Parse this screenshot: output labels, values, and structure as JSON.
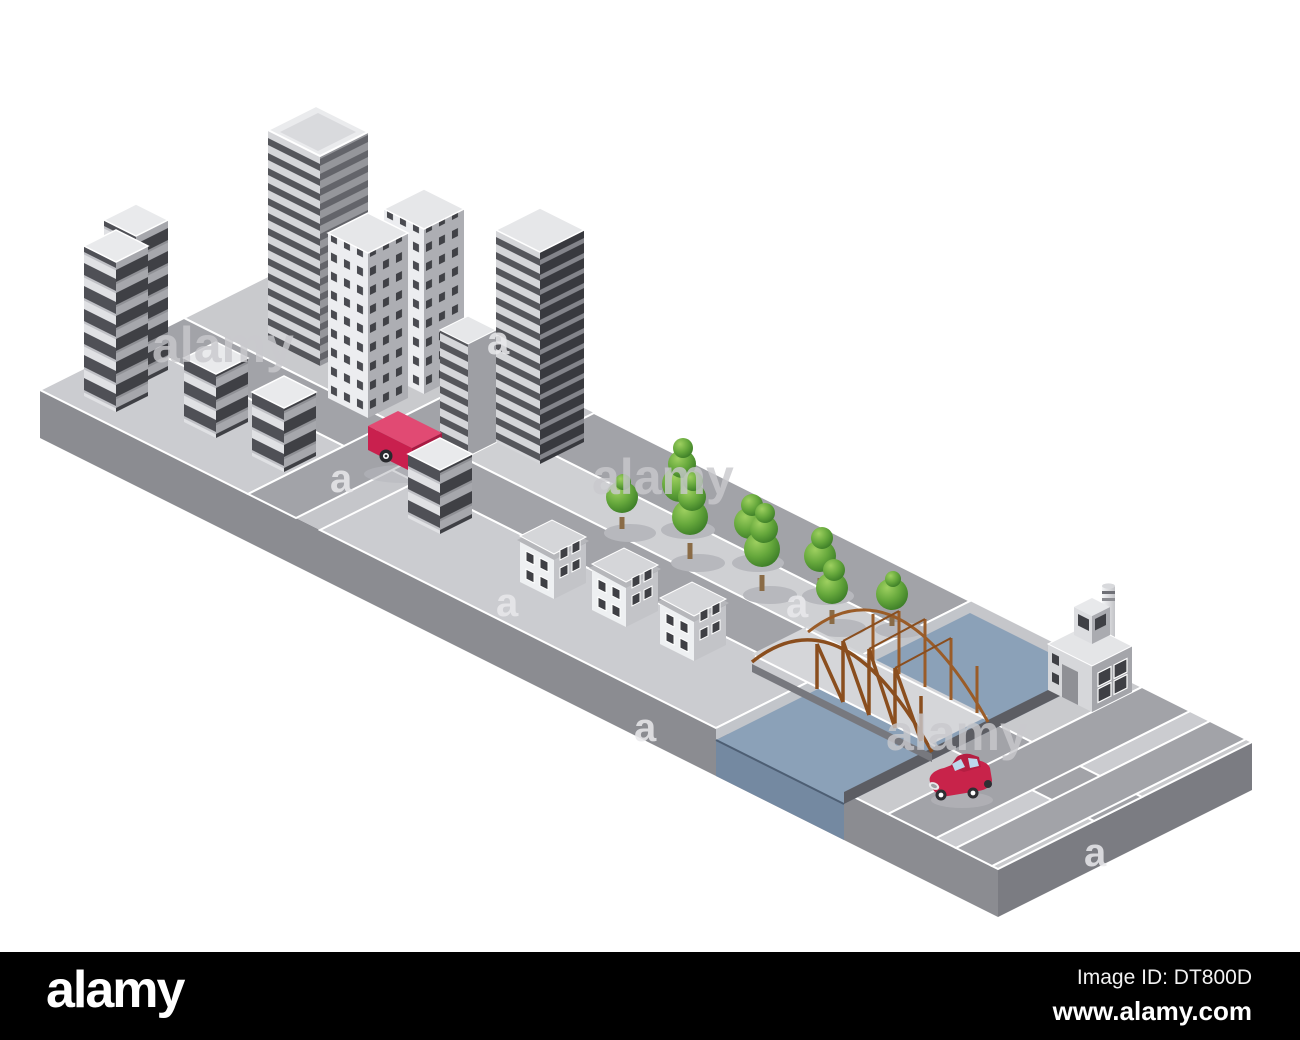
{
  "footer": {
    "logo": "alamy",
    "image_id": "Image ID: DT800D",
    "url": "www.alamy.com"
  },
  "watermark": {
    "brand": "alamy",
    "letter": "a"
  },
  "colors": {
    "background": "#ffffff",
    "footer_bg": "#000000",
    "platform_gray": "#c5c6ca",
    "platform_front": "#8b8c91",
    "platform_side": "#7b7c82",
    "road_gray": "#a2a3a8",
    "sidewalk_light": "#cccdd1",
    "water_blue": "#8ba1b8",
    "water_front": "#7489a1",
    "bridge_brown": "#8a4e1e",
    "vehicle_red": "#c9204e",
    "car_red": "#c8234a",
    "tree_green": "#66a83c",
    "building_light": "#e0e1e4",
    "building_dark": "#3a3b40",
    "window_dark": "#4f5056"
  },
  "scene": {
    "type": "isometric city vector illustration",
    "elements": [
      "platform",
      "roads",
      "skyscraper",
      "stacked-apartment-towers",
      "twin-office-towers",
      "dark-office-tower",
      "small-houses",
      "park-trees",
      "river-channel",
      "truss-bridge",
      "factory-with-chimney",
      "red-delivery-truck",
      "red-car"
    ]
  }
}
